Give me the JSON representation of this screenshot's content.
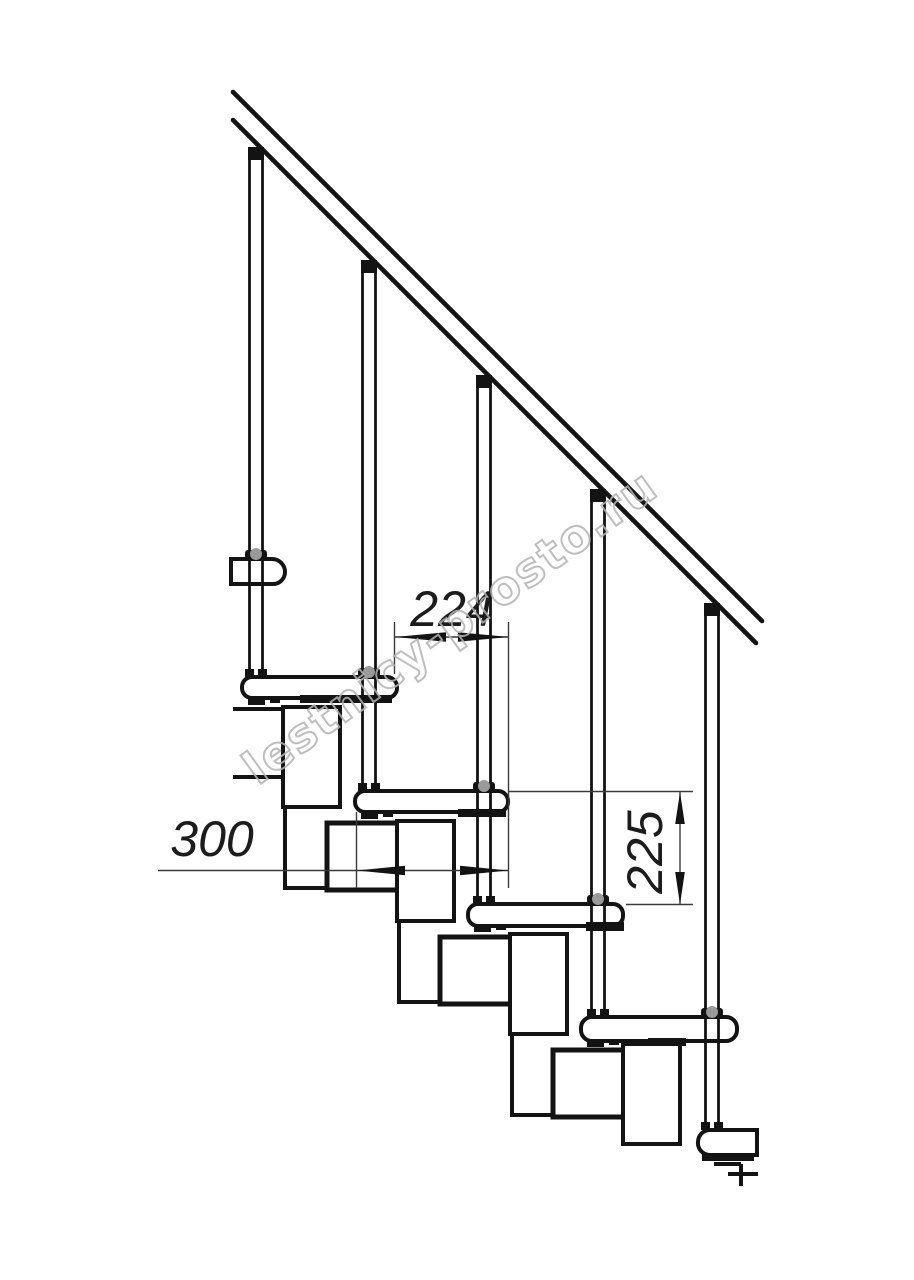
{
  "drawing": {
    "type": "staircase-side-view-technical-drawing",
    "watermark": {
      "text": "lestnicy-prosto.ru"
    },
    "dimensions": {
      "going_horizontal": "224",
      "module_length": "300",
      "riser_height": "225"
    },
    "colors": {
      "ink": "#131313",
      "dim_line": "#3a3a3a",
      "collar_gray": "#9a9a9a",
      "watermark_stroke": "#b3b3b3",
      "paper": "#ffffff"
    }
  }
}
